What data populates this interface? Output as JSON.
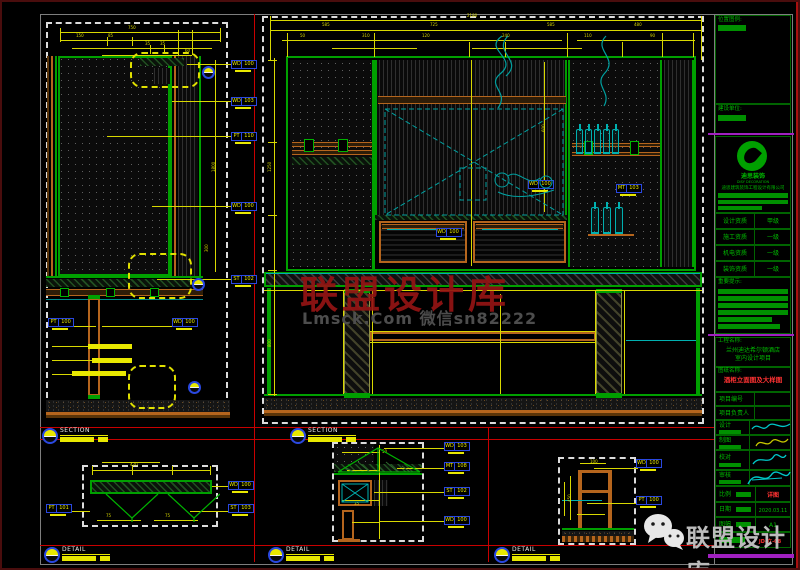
{
  "title_block": {
    "loc_label": "位置图例:",
    "client_label": "建设单位:",
    "logo_cn": "迪思装饰",
    "logo_en": "DISY DECORATION",
    "company": "迪思建筑装饰工程设计有限公司",
    "quals": [
      {
        "l": "设计资质",
        "v": "甲级"
      },
      {
        "l": "施工资质",
        "v": "一级"
      },
      {
        "l": "机电资质",
        "v": "一级"
      },
      {
        "l": "装饰资质",
        "v": "一级"
      }
    ],
    "notice_label": "重要提示:",
    "proj_label": "工程名称:",
    "proj1": "兰州迪达希尔顿酒店",
    "proj2": "室内设计项目",
    "dwg_label": "图纸名称:",
    "dwg_name": "酒柜立面图及大样图",
    "row_no": "项目编号",
    "row_mgr": "项目负责人",
    "row_design": "设计",
    "row_draft": "制图",
    "row_check": "校对",
    "row_approve": "审核",
    "scale_label": "比例",
    "scale_value": "详图",
    "date_label": "日期",
    "date_value": "2020.03.11",
    "size_label": "图幅",
    "size_value": "A1",
    "dwg_no": "JD-立-08"
  },
  "watermarks": {
    "center_red": "联盟设计库",
    "center_gray": "Lmsck.Com 微信sn82222",
    "corner": "联盟设计库"
  },
  "markers": [
    {
      "x": 40,
      "y": 426,
      "label": "SECTION"
    },
    {
      "x": 288,
      "y": 426,
      "label": "SECTION"
    },
    {
      "x": 42,
      "y": 545,
      "label": "DETAIL"
    },
    {
      "x": 266,
      "y": 545,
      "label": "DETAIL"
    },
    {
      "x": 492,
      "y": 545,
      "label": "DETAIL"
    }
  ],
  "material_tags": [
    {
      "x": 229,
      "y": 58,
      "code": "WD",
      "num": "100"
    },
    {
      "x": 229,
      "y": 95,
      "code": "WD",
      "num": "103"
    },
    {
      "x": 229,
      "y": 130,
      "code": "PT",
      "num": "110"
    },
    {
      "x": 229,
      "y": 200,
      "code": "WD",
      "num": "100"
    },
    {
      "x": 229,
      "y": 273,
      "code": "ST",
      "num": "102"
    },
    {
      "x": 170,
      "y": 316,
      "code": "WD",
      "num": "100"
    },
    {
      "x": 46,
      "y": 316,
      "code": "PT",
      "num": "100"
    },
    {
      "x": 526,
      "y": 178,
      "code": "WD",
      "num": "100"
    },
    {
      "x": 614,
      "y": 182,
      "code": "MT",
      "num": "103"
    },
    {
      "x": 434,
      "y": 226,
      "code": "WD",
      "num": "100"
    },
    {
      "x": 226,
      "y": 479,
      "code": "WD",
      "num": "100"
    },
    {
      "x": 226,
      "y": 502,
      "code": "ST",
      "num": "103"
    },
    {
      "x": 44,
      "y": 502,
      "code": "PT",
      "num": "101"
    },
    {
      "x": 442,
      "y": 440,
      "code": "WD",
      "num": "103"
    },
    {
      "x": 442,
      "y": 460,
      "code": "MT",
      "num": "108"
    },
    {
      "x": 442,
      "y": 485,
      "code": "ST",
      "num": "102"
    },
    {
      "x": 442,
      "y": 514,
      "code": "WD",
      "num": "100"
    },
    {
      "x": 634,
      "y": 457,
      "code": "WD",
      "num": "100"
    },
    {
      "x": 634,
      "y": 494,
      "code": "PT",
      "num": "100"
    }
  ],
  "bottles": [
    {
      "x": 574,
      "y": 127,
      "w": 7,
      "h": 25
    },
    {
      "x": 583,
      "y": 127,
      "w": 7,
      "h": 25
    },
    {
      "x": 592,
      "y": 127,
      "w": 7,
      "h": 25
    },
    {
      "x": 601,
      "y": 127,
      "w": 7,
      "h": 25
    },
    {
      "x": 610,
      "y": 127,
      "w": 7,
      "h": 25
    },
    {
      "x": 589,
      "y": 205,
      "w": 8,
      "h": 27
    },
    {
      "x": 601,
      "y": 205,
      "w": 8,
      "h": 27
    },
    {
      "x": 613,
      "y": 205,
      "w": 8,
      "h": 27
    }
  ],
  "circles": [
    {
      "x": 200,
      "y": 64
    },
    {
      "x": 190,
      "y": 276
    },
    {
      "x": 186,
      "y": 379
    }
  ],
  "callouts": [
    {
      "x": 128,
      "y": 50,
      "w": 70,
      "h": 36
    },
    {
      "x": 126,
      "y": 251,
      "w": 64,
      "h": 46
    },
    {
      "x": 126,
      "y": 363,
      "w": 48,
      "h": 44
    }
  ],
  "note_bars": [
    {
      "x": 86,
      "y": 342,
      "w": 44
    },
    {
      "x": 90,
      "y": 356,
      "w": 40
    },
    {
      "x": 70,
      "y": 369,
      "w": 54
    }
  ],
  "shapes": [
    [
      "db",
      44,
      20,
      182,
      396
    ],
    [
      "dots",
      56,
      54,
      112,
      220
    ],
    [
      "gb",
      56,
      54,
      112,
      220
    ],
    [
      "br",
      45,
      54,
      2,
      220
    ],
    [
      "o2",
      49,
      54,
      2,
      220
    ],
    [
      "g2",
      53,
      54,
      2,
      220
    ],
    [
      "g2",
      168,
      54,
      2,
      220
    ],
    [
      "o2",
      172,
      54,
      2,
      220
    ],
    [
      "vhatch",
      176,
      54,
      20,
      220
    ],
    [
      "g2",
      197,
      54,
      2,
      220
    ],
    [
      "ghatch",
      138,
      56,
      44,
      8
    ],
    [
      "vhatch",
      152,
      66,
      16,
      16
    ],
    [
      "g2",
      44,
      274,
      157,
      2
    ],
    [
      "ghatch",
      44,
      277,
      157,
      8
    ],
    [
      "wood",
      44,
      287,
      157,
      7
    ],
    [
      "gsq",
      58,
      286,
      9,
      9
    ],
    [
      "gsq",
      104,
      286,
      9,
      9
    ],
    [
      "gsq",
      148,
      286,
      9,
      9
    ],
    [
      "tealL",
      44,
      297,
      157
    ],
    [
      "ob",
      86,
      296,
      12,
      98
    ],
    [
      "g2",
      86,
      293,
      12,
      4
    ],
    [
      "g2",
      86,
      393,
      12,
      4
    ],
    [
      "speckle",
      44,
      398,
      184,
      12
    ],
    [
      "o2",
      44,
      410,
      184,
      3
    ],
    [
      "br",
      44,
      413,
      184,
      3
    ],
    [
      "y",
      58,
      30,
      160
    ],
    [
      "y",
      58,
      38,
      160
    ],
    [
      "y",
      70,
      46,
      140
    ],
    [
      "y",
      100,
      53,
      90
    ],
    [
      "yv",
      58,
      26,
      14
    ],
    [
      "yv",
      218,
      26,
      14
    ],
    [
      "yv",
      105,
      35,
      9
    ],
    [
      "yv",
      130,
      35,
      9
    ],
    [
      "yv",
      148,
      43,
      9
    ],
    [
      "yv",
      162,
      43,
      9
    ],
    [
      "yv",
      176,
      28,
      25
    ],
    [
      "yv",
      190,
      28,
      25
    ],
    [
      "yv",
      213,
      58,
      212
    ],
    [
      "y",
      185,
      62,
      44
    ],
    [
      "y",
      170,
      99,
      59
    ],
    [
      "y",
      105,
      134,
      124
    ],
    [
      "y",
      150,
      204,
      79
    ],
    [
      "y",
      155,
      277,
      74
    ],
    [
      "y",
      100,
      324,
      70
    ],
    [
      "y",
      72,
      324,
      22
    ],
    [
      "y",
      50,
      344,
      36
    ],
    [
      "y",
      50,
      358,
      40
    ],
    [
      "y",
      50,
      372,
      20
    ],
    [
      "t",
      126,
      24,
      "750"
    ],
    [
      "t",
      74,
      32,
      "150"
    ],
    [
      "t",
      106,
      32,
      "85"
    ],
    [
      "t",
      143,
      40,
      "35"
    ],
    [
      "t",
      158,
      40,
      "35"
    ],
    [
      "t",
      183,
      47,
      "60"
    ],
    [
      "tr",
      210,
      170,
      "1800"
    ],
    [
      "tr",
      203,
      250,
      "300"
    ],
    [
      "db",
      260,
      14,
      442,
      408
    ],
    [
      "gb",
      284,
      54,
      410,
      215
    ],
    [
      "dots",
      288,
      58,
      82,
      207
    ],
    [
      "wood",
      290,
      140,
      80,
      5
    ],
    [
      "wood",
      290,
      148,
      80,
      5
    ],
    [
      "gsq",
      302,
      137,
      10,
      13
    ],
    [
      "gsq",
      336,
      137,
      10,
      13
    ],
    [
      "ghatch",
      290,
      155,
      80,
      8
    ],
    [
      "g2",
      370,
      58,
      3,
      210
    ],
    [
      "vhatch",
      373,
      58,
      192,
      157
    ],
    [
      "g2",
      373,
      58,
      2,
      157
    ],
    [
      "g2",
      563,
      58,
      2,
      157
    ],
    [
      "wood",
      376,
      94,
      188,
      8
    ],
    [
      "ghatch",
      373,
      213,
      192,
      5
    ],
    [
      "drawerfill",
      377,
      219,
      88,
      42
    ],
    [
      "drawerfill",
      471,
      219,
      93,
      42
    ],
    [
      "wood",
      380,
      222,
      82,
      5
    ],
    [
      "wood",
      474,
      222,
      87,
      5
    ],
    [
      "dots",
      568,
      58,
      92,
      207
    ],
    [
      "g2",
      566,
      58,
      2,
      207
    ],
    [
      "g2",
      658,
      58,
      2,
      207
    ],
    [
      "wood",
      570,
      141,
      88,
      4
    ],
    [
      "wood",
      570,
      150,
      88,
      4
    ],
    [
      "gsq",
      582,
      139,
      9,
      14
    ],
    [
      "gsq",
      628,
      139,
      9,
      14
    ],
    [
      "o2",
      586,
      232,
      46,
      2
    ],
    [
      "vhatch",
      662,
      58,
      28,
      207
    ],
    [
      "g2",
      690,
      58,
      2,
      207
    ],
    [
      "dhatch",
      262,
      270,
      438,
      15
    ],
    [
      "gb",
      262,
      270,
      438,
      15
    ],
    [
      "post",
      342,
      290,
      26,
      102
    ],
    [
      "post",
      594,
      290,
      26,
      102
    ],
    [
      "g2",
      342,
      287,
      26,
      4
    ],
    [
      "g2",
      342,
      391,
      26,
      5
    ],
    [
      "g2",
      594,
      287,
      26,
      4
    ],
    [
      "g2",
      594,
      391,
      26,
      5
    ],
    [
      "ob",
      368,
      330,
      226,
      9
    ],
    [
      "gb",
      265,
      286,
      4,
      106
    ],
    [
      "gb",
      694,
      286,
      4,
      106
    ],
    [
      "g2",
      262,
      392,
      438,
      2
    ],
    [
      "speckle",
      262,
      396,
      438,
      12
    ],
    [
      "o2",
      262,
      408,
      438,
      3
    ],
    [
      "br",
      262,
      411,
      438,
      3
    ],
    [
      "y",
      268,
      18,
      432
    ],
    [
      "y",
      268,
      28,
      432
    ],
    [
      "y",
      280,
      38,
      280
    ],
    [
      "y",
      575,
      38,
      118
    ],
    [
      "y",
      330,
      46,
      85
    ],
    [
      "y",
      470,
      46,
      110
    ],
    [
      "yv",
      268,
      14,
      44
    ],
    [
      "yv",
      699,
      14,
      44
    ],
    [
      "yv",
      285,
      31,
      24
    ],
    [
      "yv",
      372,
      31,
      24
    ],
    [
      "yv",
      467,
      40,
      15
    ],
    [
      "yv",
      503,
      40,
      15
    ],
    [
      "yv",
      565,
      31,
      24
    ],
    [
      "yv",
      620,
      40,
      15
    ],
    [
      "yv",
      660,
      31,
      24
    ],
    [
      "yv",
      691,
      31,
      24
    ],
    [
      "yv",
      272,
      56,
      338
    ],
    [
      "y",
      266,
      58,
      9
    ],
    [
      "y",
      266,
      140,
      9
    ],
    [
      "y",
      266,
      213,
      9
    ],
    [
      "y",
      266,
      268,
      9
    ],
    [
      "y",
      266,
      392,
      9
    ],
    [
      "yv",
      469,
      58,
      206
    ],
    [
      "yv",
      542,
      60,
      150
    ],
    [
      "y",
      262,
      288,
      438
    ],
    [
      "yv",
      341,
      289,
      103
    ],
    [
      "yv",
      370,
      289,
      103
    ],
    [
      "yv",
      593,
      289,
      103
    ],
    [
      "yv",
      622,
      289,
      103
    ],
    [
      "y",
      368,
      329,
      226
    ],
    [
      "y",
      368,
      340,
      226
    ],
    [
      "yv",
      498,
      292,
      100
    ],
    [
      "c",
      264,
      271,
      434
    ],
    [
      "c",
      624,
      338,
      70
    ],
    [
      "c",
      385,
      227,
      72
    ],
    [
      "c",
      480,
      227,
      76
    ],
    [
      "t",
      465,
      12,
      "2180"
    ],
    [
      "t",
      320,
      21,
      "585"
    ],
    [
      "t",
      428,
      21,
      "725"
    ],
    [
      "t",
      545,
      21,
      "585"
    ],
    [
      "t",
      632,
      21,
      "480"
    ],
    [
      "t",
      298,
      32,
      "50"
    ],
    [
      "t",
      360,
      32,
      "310"
    ],
    [
      "t",
      420,
      32,
      "120"
    ],
    [
      "t",
      500,
      32,
      "240"
    ],
    [
      "t",
      582,
      32,
      "110"
    ],
    [
      "t",
      648,
      32,
      "90"
    ],
    [
      "tr",
      266,
      170,
      "1250"
    ],
    [
      "tr",
      266,
      345,
      "800"
    ],
    [
      "tr",
      540,
      130,
      "600"
    ],
    [
      "db",
      80,
      463,
      136,
      62
    ],
    [
      "ghatch",
      88,
      478,
      122,
      14
    ],
    [
      "gb",
      88,
      478,
      122,
      14
    ],
    [
      "y",
      90,
      468,
      118
    ],
    [
      "y",
      100,
      460,
      58
    ],
    [
      "y",
      95,
      518,
      44
    ],
    [
      "y",
      152,
      518,
      44
    ],
    [
      "y",
      210,
      484,
      18
    ],
    [
      "y",
      188,
      509,
      40
    ],
    [
      "y",
      68,
      509,
      20
    ],
    [
      "yv",
      90,
      464,
      9
    ],
    [
      "yv",
      130,
      464,
      9
    ],
    [
      "yv",
      170,
      464,
      9
    ],
    [
      "yv",
      208,
      464,
      9
    ],
    [
      "t",
      128,
      461,
      "420"
    ],
    [
      "t",
      104,
      512,
      "75"
    ],
    [
      "t",
      163,
      512,
      "75"
    ],
    [
      "db",
      330,
      440,
      92,
      100
    ],
    [
      "dots",
      332,
      442,
      40,
      20
    ],
    [
      "ghatch",
      332,
      462,
      88,
      8
    ],
    [
      "g2",
      332,
      471,
      88,
      2
    ],
    [
      "ob",
      336,
      478,
      34,
      26
    ],
    [
      "vhatch",
      372,
      478,
      14,
      26
    ],
    [
      "ob",
      340,
      508,
      12,
      30
    ],
    [
      "o2",
      336,
      537,
      22,
      3
    ],
    [
      "yv",
      377,
      443,
      94
    ],
    [
      "y",
      340,
      450,
      38
    ],
    [
      "y",
      345,
      468,
      33
    ],
    [
      "y",
      340,
      498,
      38
    ],
    [
      "y",
      350,
      520,
      28
    ],
    [
      "y",
      382,
      446,
      61
    ],
    [
      "y",
      395,
      466,
      48
    ],
    [
      "y",
      372,
      490,
      71
    ],
    [
      "y",
      377,
      519,
      66
    ],
    [
      "t",
      380,
      448,
      "50"
    ],
    [
      "t",
      352,
      500,
      "35"
    ],
    [
      "db",
      556,
      455,
      78,
      88
    ],
    [
      "ob",
      576,
      468,
      4,
      58
    ],
    [
      "ob",
      606,
      468,
      4,
      58
    ],
    [
      "o2",
      576,
      468,
      34,
      3
    ],
    [
      "o2",
      576,
      488,
      34,
      3
    ],
    [
      "g2",
      560,
      526,
      72,
      2
    ],
    [
      "speckle",
      560,
      529,
      72,
      5
    ],
    [
      "woodwave",
      560,
      534,
      72,
      6
    ],
    [
      "c",
      560,
      498,
      40
    ],
    [
      "y",
      592,
      466,
      44
    ],
    [
      "y",
      585,
      501,
      50
    ],
    [
      "yv",
      568,
      474,
      44
    ],
    [
      "yv",
      562,
      480,
      34
    ],
    [
      "y",
      578,
      461,
      26
    ],
    [
      "y",
      575,
      512,
      28
    ],
    [
      "t",
      588,
      458,
      "100"
    ],
    [
      "tr",
      566,
      500,
      "450"
    ]
  ]
}
